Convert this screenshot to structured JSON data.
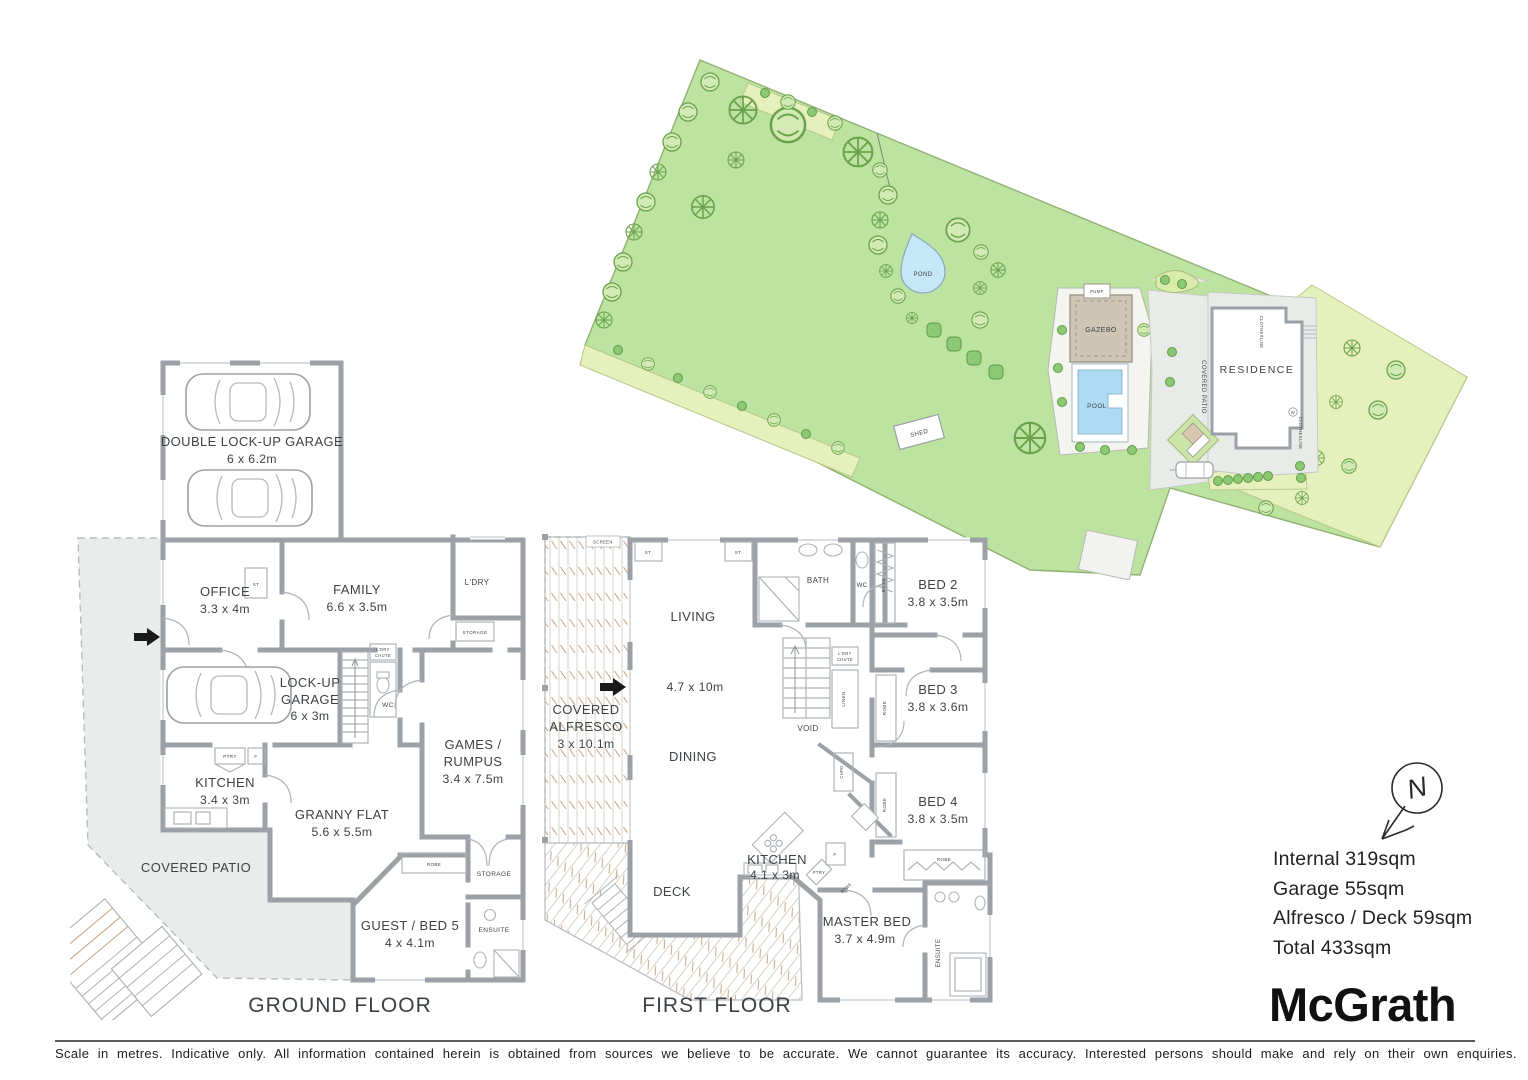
{
  "site": {
    "labels": {
      "pond": "POND",
      "shed": "SHED",
      "pump": "PUMP",
      "gazebo": "GAZEBO",
      "pool": "POOL",
      "covered_patio": "COVERED PATIO",
      "residence": "RESIDENCE",
      "clothesline": "CLOTHESLINE",
      "w": "W"
    }
  },
  "glossary": {
    "st": "ST",
    "robe": "ROBE",
    "storage": "STORAGE",
    "wc": "WC",
    "ensuite": "ENSUITE",
    "f": "F",
    "ptry": "PTRY",
    "linen": "LINEN",
    "cupd": "CUPD",
    "void": "VOID",
    "ldry": "L'DRY",
    "chute": "CHUTE",
    "screen": "SCREEN",
    "bath": "BATH",
    "deck": "DECK",
    "covered_patio": "COVERED PATIO"
  },
  "ground_floor": {
    "caption": "GROUND FLOOR",
    "rooms": {
      "double_garage": {
        "name": "DOUBLE LOCK-UP GARAGE",
        "dims": "6 x 6.2m"
      },
      "office": {
        "name": "OFFICE",
        "dims": "3.3 x 4m"
      },
      "family": {
        "name": "FAMILY",
        "dims": "6.6 x 3.5m"
      },
      "lockup_garage": {
        "name1": "LOCK-UP",
        "name2": "GARAGE",
        "dims": "6 x 3m"
      },
      "games": {
        "name1": "GAMES /",
        "name2": "RUMPUS",
        "dims": "3.4 x 7.5m"
      },
      "kitchen": {
        "name": "KITCHEN",
        "dims": "3.4 x 3m"
      },
      "granny_flat": {
        "name": "GRANNY FLAT",
        "dims": "5.6 x 5.5m"
      },
      "guest": {
        "name": "GUEST / BED 5",
        "dims": "4 x 4.1m"
      }
    }
  },
  "first_floor": {
    "caption": "FIRST FLOOR",
    "rooms": {
      "living": {
        "name": "LIVING",
        "dims": "4.7 x 10m"
      },
      "dining": {
        "name": "DINING"
      },
      "alfresco": {
        "name1": "COVERED",
        "name2": "ALFRESCO",
        "dims": "3 x 10.1m"
      },
      "bed2": {
        "name": "BED 2",
        "dims": "3.8 x 3.5m"
      },
      "bed3": {
        "name": "BED 3",
        "dims": "3.8 x 3.6m"
      },
      "bed4": {
        "name": "BED 4",
        "dims": "3.8 x 3.5m"
      },
      "kitchen": {
        "name": "KITCHEN",
        "dims": "4.1 x 3m"
      },
      "master": {
        "name": "MASTER BED",
        "dims": "3.7 x 4.9m"
      }
    }
  },
  "areas": {
    "internal": "Internal 319sqm",
    "garage": "Garage 55sqm",
    "alfresco_deck": "Alfresco / Deck 59sqm",
    "total": "Total 433sqm"
  },
  "compass": {
    "letter": "N"
  },
  "brand": {
    "logo": "McGrath"
  },
  "footer": {
    "disclaimer": "Scale in metres. Indicative only. All information contained herein is obtained from sources we believe to be accurate. We cannot guarantee its accuracy. Interested persons should make and rely on their own enquiries."
  }
}
